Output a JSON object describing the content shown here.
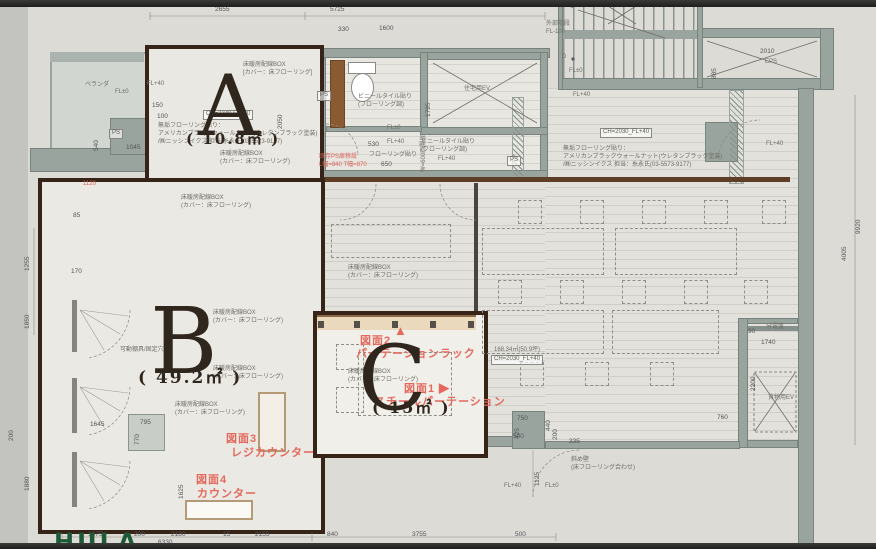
{
  "colors": {
    "accent_red": "#e4685c",
    "wall_gray": "#9aa49e",
    "wood_brown": "#5e3e25",
    "outline_dark": "#362418",
    "paper": "#dcdbd6",
    "counter_beige": "#ead9bc",
    "logo_green": "#1d5b37"
  },
  "logo": {
    "text": "HULA"
  },
  "rooms": [
    {
      "letter": "A",
      "area": "( 10.8㎡ )",
      "x": 198,
      "y": 64,
      "size": 84,
      "ax": 186,
      "ay": 132,
      "asize": 15
    },
    {
      "letter": "B",
      "area": "( 49.2㎡ )",
      "x": 150,
      "y": 296,
      "size": 92,
      "ax": 138,
      "ay": 370,
      "asize": 17
    },
    {
      "letter": "C",
      "area": "( 15㎡ )",
      "x": 358,
      "y": 334,
      "size": 90,
      "ax": 372,
      "ay": 400,
      "asize": 16
    }
  ],
  "callouts": [
    {
      "t": "図面2",
      "x": 360,
      "y": 334
    },
    {
      "t": "パーテーションラック",
      "x": 356,
      "y": 347
    },
    {
      "t": "▲",
      "x": 394,
      "y": 323,
      "arrow": true
    },
    {
      "t": "図面1",
      "x": 404,
      "y": 382
    },
    {
      "t": "▶",
      "x": 439,
      "y": 380,
      "arrow": true
    },
    {
      "t": "スチールパーテーション",
      "x": 374,
      "y": 395
    },
    {
      "t": "図面3",
      "x": 226,
      "y": 432
    },
    {
      "t": "レジカウンター",
      "x": 231,
      "y": 446
    },
    {
      "t": "図面4",
      "x": 196,
      "y": 473
    },
    {
      "t": "カウンター",
      "x": 197,
      "y": 487
    }
  ],
  "red_notes": [
    {
      "t": "1120",
      "x": 83,
      "y": 181
    },
    {
      "t": "既存PS扉移設\nL幅=840 T幅=870",
      "x": 319,
      "y": 154
    }
  ],
  "boxed_notes": [
    {
      "t": "CH=2340 FL+40",
      "x": 203,
      "y": 110
    },
    {
      "t": "CH=2030_FL+40",
      "x": 600,
      "y": 128
    },
    {
      "t": "CH=2030_FL+40",
      "x": 491,
      "y": 355
    },
    {
      "t": "PS",
      "x": 109,
      "y": 129
    },
    {
      "t": "PS",
      "x": 507,
      "y": 156
    },
    {
      "t": "PS",
      "x": 317,
      "y": 91
    }
  ],
  "dims": [
    {
      "t": "2655",
      "x": 215,
      "y": 6
    },
    {
      "t": "5725",
      "x": 330,
      "y": 6
    },
    {
      "t": "330",
      "x": 338,
      "y": 26
    },
    {
      "t": "1600",
      "x": 379,
      "y": 25
    },
    {
      "t": "2010",
      "x": 760,
      "y": 48
    },
    {
      "t": "1740",
      "x": 761,
      "y": 339
    },
    {
      "t": "90",
      "x": 748,
      "y": 328
    },
    {
      "t": "760",
      "x": 717,
      "y": 414
    },
    {
      "t": "335",
      "x": 569,
      "y": 438
    },
    {
      "t": "1675",
      "x": 88,
      "y": 531
    },
    {
      "t": "200",
      "x": 134,
      "y": 531
    },
    {
      "t": "2180",
      "x": 171,
      "y": 531
    },
    {
      "t": "15",
      "x": 223,
      "y": 531
    },
    {
      "t": "2155",
      "x": 255,
      "y": 531
    },
    {
      "t": "840",
      "x": 327,
      "y": 531
    },
    {
      "t": "3755",
      "x": 412,
      "y": 531
    },
    {
      "t": "500",
      "x": 515,
      "y": 531
    },
    {
      "t": "6330",
      "x": 158,
      "y": 539
    },
    {
      "t": "150",
      "x": 152,
      "y": 102
    },
    {
      "t": "100",
      "x": 157,
      "y": 113
    },
    {
      "t": "1045",
      "x": 126,
      "y": 144
    },
    {
      "t": "85",
      "x": 73,
      "y": 212
    },
    {
      "t": "170",
      "x": 71,
      "y": 268
    },
    {
      "t": "1645",
      "x": 90,
      "y": 421
    },
    {
      "t": "795",
      "x": 140,
      "y": 419
    },
    {
      "t": "530",
      "x": 368,
      "y": 141
    },
    {
      "t": "650",
      "x": 381,
      "y": 161
    },
    {
      "t": "500",
      "x": 513,
      "y": 433
    },
    {
      "t": "750",
      "x": 517,
      "y": 415
    },
    {
      "t": "1255",
      "x": 24,
      "y": 271,
      "v": true
    },
    {
      "t": "1850",
      "x": 24,
      "y": 329,
      "v": true
    },
    {
      "t": "200",
      "x": 8,
      "y": 441,
      "v": true
    },
    {
      "t": "1880",
      "x": 24,
      "y": 491,
      "v": true
    },
    {
      "t": "540",
      "x": 93,
      "y": 151,
      "v": true
    },
    {
      "t": "770",
      "x": 134,
      "y": 445,
      "v": true
    },
    {
      "t": "1625",
      "x": 178,
      "y": 499,
      "v": true
    },
    {
      "t": "1795",
      "x": 425,
      "y": 117,
      "v": true
    },
    {
      "t": "2050",
      "x": 277,
      "y": 129,
      "v": true
    },
    {
      "t": "885",
      "x": 711,
      "y": 79,
      "v": true
    },
    {
      "t": "2200",
      "x": 750,
      "y": 391,
      "v": true
    },
    {
      "t": "9920",
      "x": 855,
      "y": 234,
      "v": true
    },
    {
      "t": "4005",
      "x": 841,
      "y": 261,
      "v": true
    },
    {
      "t": "440",
      "x": 545,
      "y": 431,
      "v": true
    },
    {
      "t": "200",
      "x": 552,
      "y": 440,
      "v": true
    },
    {
      "t": "425",
      "x": 514,
      "y": 439,
      "v": true
    },
    {
      "t": "1125",
      "x": 534,
      "y": 486,
      "v": true
    }
  ],
  "notes": [
    {
      "t": "FL+40",
      "x": 147,
      "y": 81
    },
    {
      "t": "FL±0",
      "x": 115,
      "y": 89
    },
    {
      "t": "ベランダ",
      "x": 85,
      "y": 82
    },
    {
      "t": "U",
      "x": 561,
      "y": 1
    },
    {
      "t": "D",
      "x": 562,
      "y": 54
    },
    {
      "t": "床暖房配線BOX\n[カバー：床フローリング]",
      "x": 243,
      "y": 62
    },
    {
      "t": "無垢フローリング貼り：\nアメリカンブラックウォールナット(ウレタンブラック塗装)\n/㈱ニッシンイクス 担当:糸永氏(03-5573-9177)",
      "x": 158,
      "y": 123
    },
    {
      "t": "床暖房配線BOX\n(カバー：床フローリング)",
      "x": 220,
      "y": 151
    },
    {
      "t": "床暖房配線BOX\n(カバー：床フローリング)",
      "x": 181,
      "y": 195
    },
    {
      "t": "床暖房配線BOX\n(カバー：床フローリング)",
      "x": 213,
      "y": 310
    },
    {
      "t": "床暖房配線BOX\n(カバー：床フローリング)",
      "x": 213,
      "y": 366
    },
    {
      "t": "床暖房配線BOX\n(カバー：床フローリング)",
      "x": 175,
      "y": 402
    },
    {
      "t": "可動棚具/固定穴",
      "x": 120,
      "y": 347
    },
    {
      "t": "床暖房配線BOX\n(カバー：床フローリング)",
      "x": 348,
      "y": 265
    },
    {
      "t": "床暖房配線BOX\n(カバー：床フローリング)",
      "x": 348,
      "y": 369
    },
    {
      "t": "ビニールタイル貼り\n(フローリング調)",
      "x": 358,
      "y": 94
    },
    {
      "t": "ビニールタイル貼り\n(フローリング調)",
      "x": 421,
      "y": 139
    },
    {
      "t": "フローリング貼り",
      "x": 369,
      "y": 152
    },
    {
      "t": "FL±0",
      "x": 387,
      "y": 125
    },
    {
      "t": "FL+40",
      "x": 387,
      "y": 139
    },
    {
      "t": "FL+40",
      "x": 438,
      "y": 156
    },
    {
      "t": "住宅用EV",
      "x": 464,
      "y": 86
    },
    {
      "t": "外部階段\nFL-100",
      "x": 546,
      "y": 21
    },
    {
      "t": "EPS",
      "x": 765,
      "y": 59
    },
    {
      "t": "FL±0",
      "x": 569,
      "y": 68
    },
    {
      "t": "FL+40",
      "x": 573,
      "y": 92
    },
    {
      "t": "FL+40",
      "x": 766,
      "y": 141
    },
    {
      "t": "無垢フローリング貼り：\nアメリカンブラックウォールナット(ウレタンブラック塗装)\n/㈱ニッシンイクス 担当：糸永氏(03-5573-9177)",
      "x": 563,
      "y": 146
    },
    {
      "t": "168.34㎡(50.9坪)",
      "x": 494,
      "y": 347
    },
    {
      "t": "分電盤",
      "x": 766,
      "y": 324
    },
    {
      "t": "貨物用EV",
      "x": 768,
      "y": 395
    },
    {
      "t": "斜め壁\n(床フローリング合わせ)",
      "x": 571,
      "y": 457
    },
    {
      "t": "FL+40",
      "x": 504,
      "y": 483
    },
    {
      "t": "FL±0",
      "x": 545,
      "y": 483
    },
    {
      "t": "W=600両開扉",
      "x": 421,
      "y": 172,
      "v": true
    }
  ]
}
